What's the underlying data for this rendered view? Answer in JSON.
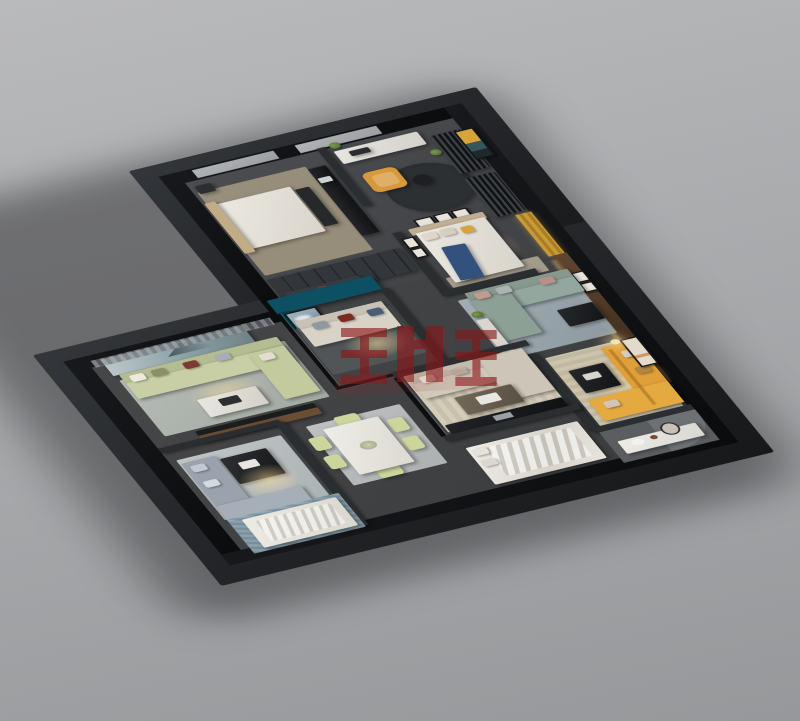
{
  "scene": {
    "kind": "3d-dollhouse-floor-plan-render",
    "background_top": "#b9babc",
    "background_bottom": "#96989b",
    "projection": {
      "rotateX_deg": 57,
      "rotateZ_deg": -24
    }
  },
  "building": {
    "wall_cap": "#0c0d0f",
    "wall_face": "#2b2d30",
    "plinth": "#232527",
    "floor_wing": "#47494c",
    "floor_main": "#414346",
    "window_glass": "#a8acae",
    "wood_panel": "#4a3524",
    "led_strip_glow": "#ffd89a"
  },
  "accents": {
    "teal_wall": "#0d5064",
    "mustard_sofa": "#dfa03a",
    "orange_chair": "#d8993d",
    "sage_sofa": "#c8cfa6",
    "sectional_sage_teal": "#93a79e",
    "cream_sofa": "#d9d3c7",
    "beige_sofa": "#d1c9ba",
    "celadon_chair": "#ccd59c",
    "blue_throw": "#32517c",
    "watermark_red": "#8c1518"
  },
  "watermark": {
    "style": "red semi-transparent block glyphs",
    "color": "#8c1518"
  },
  "rooms": [
    {
      "name": "bedroom-1 (upper wing, tan bed + tv console)"
    },
    {
      "name": "study (desk, orange lounge chair, mesh screens, round dark rug)"
    },
    {
      "name": "bedroom-2 (white bed with blue throw, gallery frames)"
    },
    {
      "name": "living-room-sectional (sage-teal L sofa, walnut panel wall)"
    },
    {
      "name": "lounge-mustard (mustard L sofa, floor lamp, framed art)"
    },
    {
      "name": "bathroom (white vanity, oval mirror, curved wall)"
    },
    {
      "name": "lounge-teal (cream sofa, petrol-teal accent wall, cloud art, glass partition)"
    },
    {
      "name": "living-room-sage (sage sectional, landscape mural, media console)"
    },
    {
      "name": "family-room (beige sectional, striped rug, glass partition)"
    },
    {
      "name": "dining-room (white table, six celadon chairs)"
    },
    {
      "name": "kids-room (grey daybed, dark coffee table, white bed, blue rug)"
    },
    {
      "name": "bedroom-3 (white rumpled bed)"
    }
  ]
}
